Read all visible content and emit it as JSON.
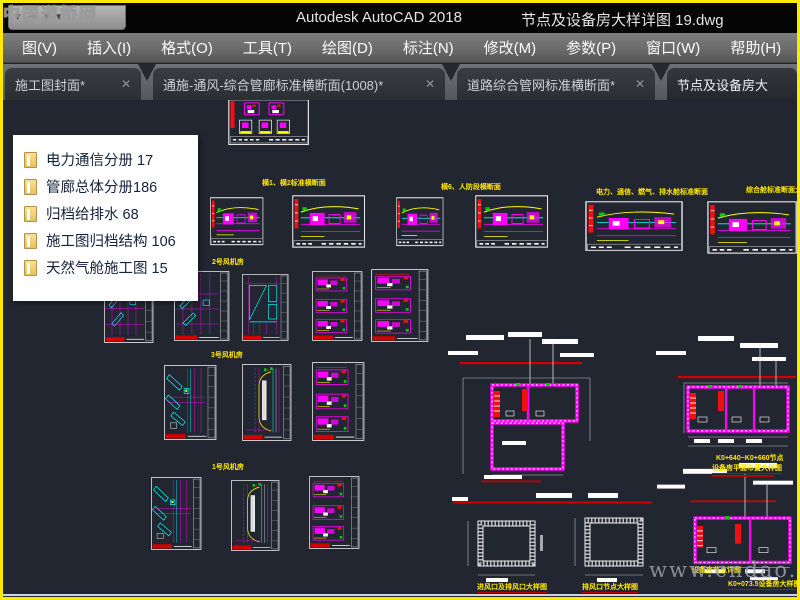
{
  "window": {
    "title_app": "Autodesk AutoCAD 2018",
    "title_doc": "节点及设备房大样详图 19.dwg",
    "watermark_topleft": "中国道桥网",
    "watermark_bottom": "www.cndao.com"
  },
  "qat": {
    "icons": [
      "workspace-dropdown",
      "plot-arrow",
      "undo-dropdown",
      "redo-dropdown"
    ]
  },
  "menu": {
    "items": [
      {
        "label": "图(V)"
      },
      {
        "label": "插入(I)"
      },
      {
        "label": "格式(O)"
      },
      {
        "label": "工具(T)"
      },
      {
        "label": "绘图(D)"
      },
      {
        "label": "标注(N)"
      },
      {
        "label": "修改(M)"
      },
      {
        "label": "参数(P)"
      },
      {
        "label": "窗口(W)"
      },
      {
        "label": "帮助(H)"
      }
    ]
  },
  "tabs": [
    {
      "label": "施工图封面*",
      "close": "✕",
      "active": false
    },
    {
      "label": "通施-通风-综合管廊标准横断面(1008)*",
      "close": "✕",
      "active": false
    },
    {
      "label": "道路综合管网标准横断面*",
      "close": "✕",
      "active": false
    },
    {
      "label": "节点及设备房大",
      "close": "",
      "active": true
    }
  ],
  "popup": {
    "items": [
      {
        "label": "电力通信分册 17"
      },
      {
        "label": "管廊总体分册186"
      },
      {
        "label": "归档给排水 68"
      },
      {
        "label": "施工图归档结构  106"
      },
      {
        "label": "天然气舱施工图  15"
      }
    ]
  },
  "colors": {
    "highlight_border": "#fde903",
    "canvas_bg": "#212631",
    "cad_magenta": "#ff00ff",
    "cad_cyan": "#00ffff",
    "cad_yellow": "#ffff00",
    "cad_red": "#e11111",
    "cad_green": "#00cc00",
    "cad_white": "#ffffff"
  },
  "canvas": {
    "captions": [
      {
        "x": 262,
        "y": 177,
        "t": "横1、横2标准横断面"
      },
      {
        "x": 441,
        "y": 181,
        "t": "横6、人防段横断面"
      },
      {
        "x": 596,
        "y": 186,
        "t": "电力、通信、燃气、排水舱标准断面"
      },
      {
        "x": 746,
        "y": 184,
        "t": "综合舱标准断面大样图"
      },
      {
        "x": 212,
        "y": 256,
        "t": "2号风机房"
      },
      {
        "x": 211,
        "y": 349,
        "t": "3号风机房"
      },
      {
        "x": 212,
        "y": 461,
        "t": "1号风机房"
      },
      {
        "x": 477,
        "y": 581,
        "t": "进风口及排风口大样图",
        "u": true
      },
      {
        "x": 582,
        "y": 581,
        "t": "排风口节点大样图",
        "u": true
      },
      {
        "x": 716,
        "y": 452,
        "t": "K0+640~K0+660节点"
      },
      {
        "x": 712,
        "y": 462,
        "t": "设备房平面布置大样图",
        "u": true
      },
      {
        "x": 692,
        "y": 564,
        "t": "设备房节点详图"
      },
      {
        "x": 728,
        "y": 578,
        "t": "K0+073.5设备房大样图",
        "u": true
      }
    ],
    "sheets": [
      {
        "type": "T5",
        "x": 228,
        "y": 96,
        "w": 82,
        "h": 47
      },
      {
        "type": "T1",
        "x": 210,
        "y": 194,
        "w": 54,
        "h": 52
      },
      {
        "type": "T1",
        "x": 292,
        "y": 192,
        "w": 74,
        "h": 57
      },
      {
        "type": "T1",
        "x": 396,
        "y": 194,
        "w": 48,
        "h": 53
      },
      {
        "type": "T1",
        "x": 475,
        "y": 192,
        "w": 74,
        "h": 57
      },
      {
        "type": "T1",
        "x": 585,
        "y": 198,
        "w": 99,
        "h": 54
      },
      {
        "type": "T1",
        "x": 707,
        "y": 198,
        "w": 91,
        "h": 57
      },
      {
        "type": "T2",
        "x": 104,
        "y": 264,
        "w": 50,
        "h": 76
      },
      {
        "type": "T2",
        "x": 174,
        "y": 268,
        "w": 56,
        "h": 70
      },
      {
        "type": "T2B",
        "x": 242,
        "y": 271,
        "w": 47,
        "h": 67
      },
      {
        "type": "T4",
        "x": 312,
        "y": 268,
        "w": 51,
        "h": 70
      },
      {
        "type": "T4",
        "x": 371,
        "y": 266,
        "w": 58,
        "h": 73
      },
      {
        "type": "T2C",
        "x": 164,
        "y": 362,
        "w": 53,
        "h": 75
      },
      {
        "type": "T3",
        "x": 242,
        "y": 361,
        "w": 50,
        "h": 77
      },
      {
        "type": "T4",
        "x": 312,
        "y": 359,
        "w": 53,
        "h": 79
      },
      {
        "type": "T2C",
        "x": 151,
        "y": 474,
        "w": 51,
        "h": 73
      },
      {
        "type": "T3",
        "x": 231,
        "y": 477,
        "w": 49,
        "h": 71
      },
      {
        "type": "T4",
        "x": 309,
        "y": 473,
        "w": 51,
        "h": 73
      },
      {
        "type": "PL1",
        "x": 446,
        "y": 328,
        "w": 150,
        "h": 152
      },
      {
        "type": "PL2",
        "x": 648,
        "y": 330,
        "w": 150,
        "h": 145
      },
      {
        "type": "SEC",
        "x": 446,
        "y": 488,
        "w": 132,
        "h": 100
      },
      {
        "type": "SEC2",
        "x": 555,
        "y": 488,
        "w": 110,
        "h": 100
      },
      {
        "type": "PL3",
        "x": 655,
        "y": 458,
        "w": 143,
        "h": 128
      }
    ]
  }
}
